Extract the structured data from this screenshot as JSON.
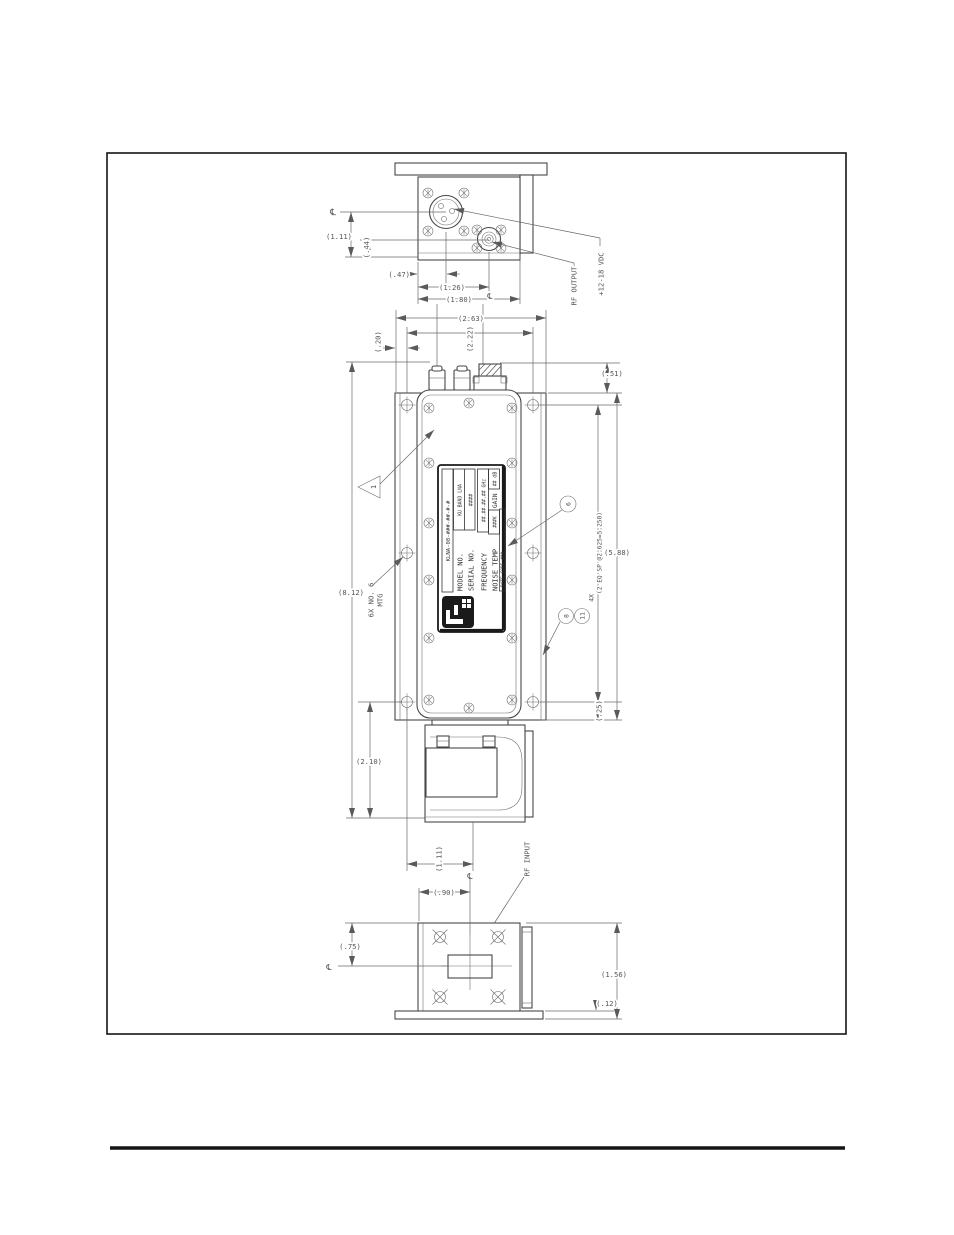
{
  "colors": {
    "ink": "#474747",
    "dim_ink": "#6a6a6a",
    "frame": "#141414"
  },
  "top_view": {
    "cl_left": "℄",
    "cl_sma": "℄",
    "dim_xlr_y": "(1.11)",
    "dim_sma_y": "(.44)",
    "dim_xlr_x": "(.47)",
    "dim_sma_x": "(1.26)",
    "dim_width": "(1.80)",
    "rf_output": "RF OUTPUT",
    "power": "+12-18 VDC"
  },
  "front_view": {
    "dim_plate_w": "(2.63)",
    "dim_holes_w": "(2.22)",
    "dim_edge": "(.20)",
    "dim_conn_h": "(.51)",
    "dim_overall_h": "(8.12)",
    "dim_flange_h": "(5.88)",
    "dim_hole_sp": "(2 EQ SP @2.625=5.250)",
    "dim_bot_margin": "(.25)",
    "mtg_note_1": "6X NO. 6",
    "mtg_note_2": "MTG",
    "rev_delta": "1",
    "balloon_6": "6",
    "balloon_8": "8",
    "balloon_11": "11",
    "balloon_qty": "4X"
  },
  "nameplate": {
    "part_number": "KLNA-08-###-##-#-#",
    "model_label": "MODEL NO.",
    "model_value": "KU BAND LNA",
    "serial_label": "SERIAL NO.",
    "serial_value": "####",
    "frequency_label": "FREQUENCY",
    "frequency_value": "##.##-##.## GHz",
    "noise_label": "NOISE TEMP",
    "noise_value": "###K",
    "gain_label": "GAIN",
    "gain_value": "## dB",
    "date_code": "DATE CODE ###"
  },
  "waveguide_view": {
    "dim_h": "(2.10)",
    "dim_center": "(1.11)",
    "cl": "℄",
    "rf_input": "RF INPUT"
  },
  "bottom_view": {
    "dim_cx": "(.90)",
    "dim_cy": "(.75)",
    "cl_left": "℄",
    "dim_h": "(1.56)",
    "dim_base": "(.12)"
  }
}
